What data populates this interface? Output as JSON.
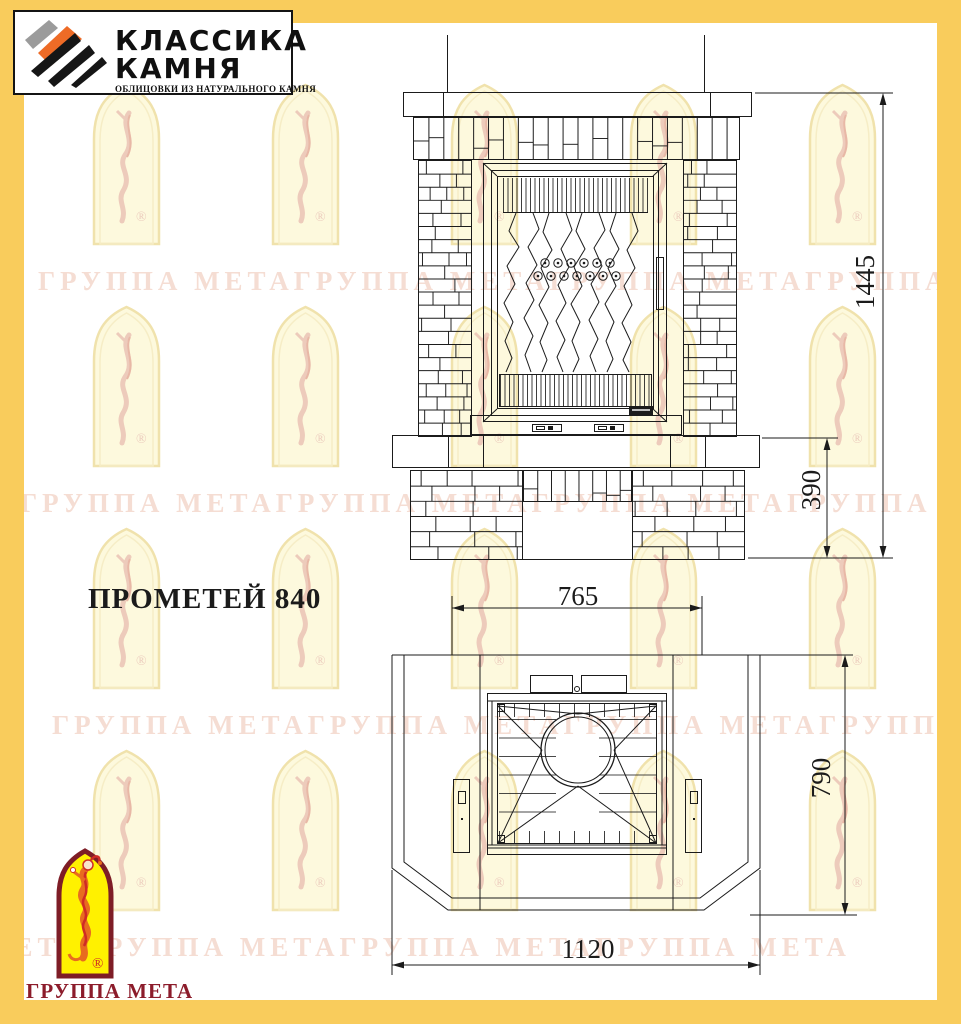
{
  "title": "ПРОМЕТЕЙ 840",
  "header_logo": {
    "line1": "КЛАССИКА",
    "line2": "КАМНЯ",
    "subtitle": "ОБЛИЦОВКИ ИЗ НАТУРАЛЬНОГО КАМНЯ"
  },
  "footer_logo": {
    "label": "ГРУППА МЕТА",
    "registered_mark": "®"
  },
  "watermark": {
    "text": "ГРУППА МЕТАГРУППА МЕТАГРУППА МЕТАГРУППА МЕТА",
    "registered_mark": "®"
  },
  "dimensions": {
    "total_height": "1445",
    "pedestal_height": "390",
    "top_width": "765",
    "depth": "790",
    "base_width": "1120"
  },
  "colors": {
    "frame_yellow": "#f9cc5c",
    "line": "#1b1b1b",
    "meta_red": "#8c1c2b",
    "watermark_text": "#f5ddd3",
    "arch_fill": "#fdf9dd",
    "logo_orange": "#ee6b26",
    "jester_yellow": "#fff100"
  }
}
